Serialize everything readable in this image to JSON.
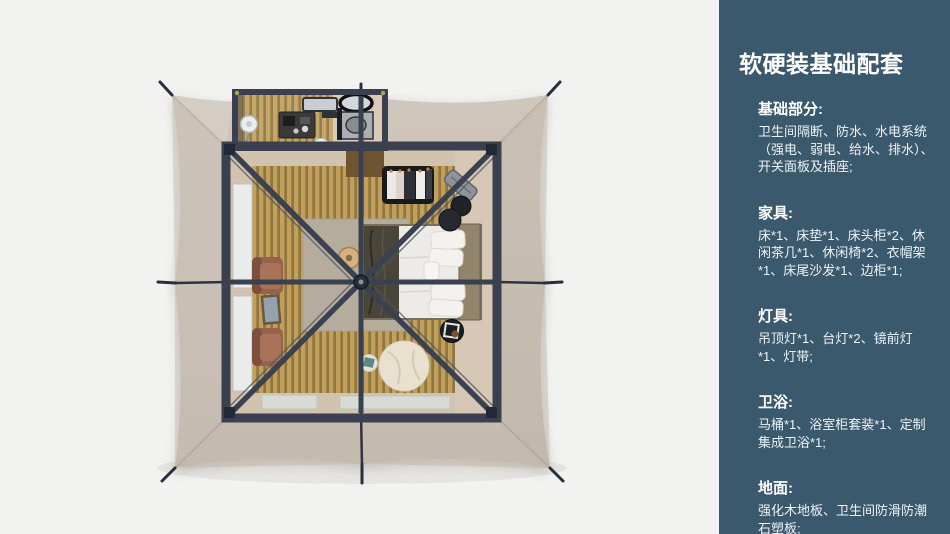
{
  "sidebar": {
    "background_color": "#3b596d",
    "text_color": "#ffffff",
    "title": "软硬装基础配套",
    "sections": [
      {
        "heading": "基础部分:",
        "body": "卫生间隔断、防水、水电系统（强电、弱电、给水、排水）、开关面板及插座;"
      },
      {
        "heading": "家具:",
        "body": "床*1、床垫*1、床头柜*2、休闲茶几*1、休闲椅*2、衣帽架*1、床尾沙发*1、边柜*1;"
      },
      {
        "heading": "灯具:",
        "body": "吊顶灯*1、台灯*2、镜前灯*1、灯带;"
      },
      {
        "heading": "卫浴:",
        "body": "马桶*1、浴室柜套装*1、定制集成卫浴*1;"
      },
      {
        "heading": "地面:",
        "body": "强化木地板、卫生间防滑防潮石塑板;"
      }
    ]
  },
  "illustration": {
    "alt": "帐篷客房顶视渲染图：中央方形客房与卫生间、四角拉索帐篷布",
    "colors": {
      "page_background": "#f2f2f1",
      "tent_canvas": "#c8beb3",
      "frame": "#3a404f",
      "wood_floor": "#c3a059",
      "wood_gap": "#8e7642",
      "interior_wall": "#d2c3ae",
      "bedding": "#edebe7",
      "throw_blanket": "#494539",
      "rug": "#b5ac9e",
      "bean_bag": "#e9e0cf",
      "armchair": "#a06b52",
      "door_mat": "#d7dbd4",
      "pouf": "#22252b"
    }
  }
}
